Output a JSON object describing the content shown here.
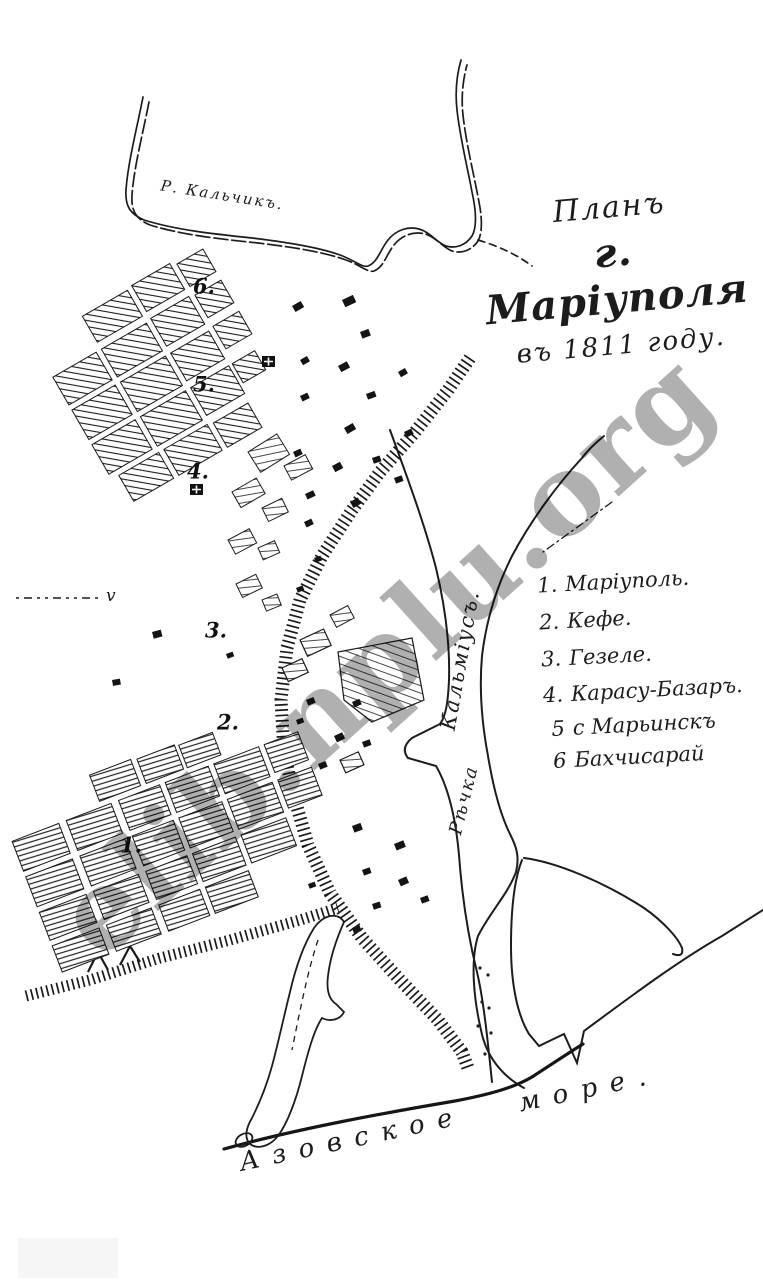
{
  "colors": {
    "paper": "#ffffff",
    "ink": "#1c1c1c",
    "watermark": "#b0b0b0"
  },
  "title": {
    "line1": "Планъ",
    "line2": "г. Маріуполя",
    "line3": "въ 1811 году."
  },
  "legend": {
    "items": [
      {
        "num": "1.",
        "name": "Маріуполь."
      },
      {
        "num": "2.",
        "name": "Кефе."
      },
      {
        "num": "3.",
        "name": "Гезеле."
      },
      {
        "num": "4.",
        "name": "Карасу-Базаръ."
      },
      {
        "num": "5",
        "name": "с Марьинскъ"
      },
      {
        "num": "6",
        "name": "Бахчисарай"
      }
    ]
  },
  "labels": {
    "river_top": "Р. Кальчикъ.",
    "river_main": "Кальміусъ.",
    "river_word": "Рѣчка",
    "sea": "Азовское море.",
    "boundary_mark": "v"
  },
  "markers": [
    {
      "label": "6."
    },
    {
      "label": "5."
    },
    {
      "label": "4."
    },
    {
      "label": "3."
    },
    {
      "label": "2."
    },
    {
      "label": "1."
    }
  ],
  "watermark": {
    "text": "elib.nplu.org"
  }
}
